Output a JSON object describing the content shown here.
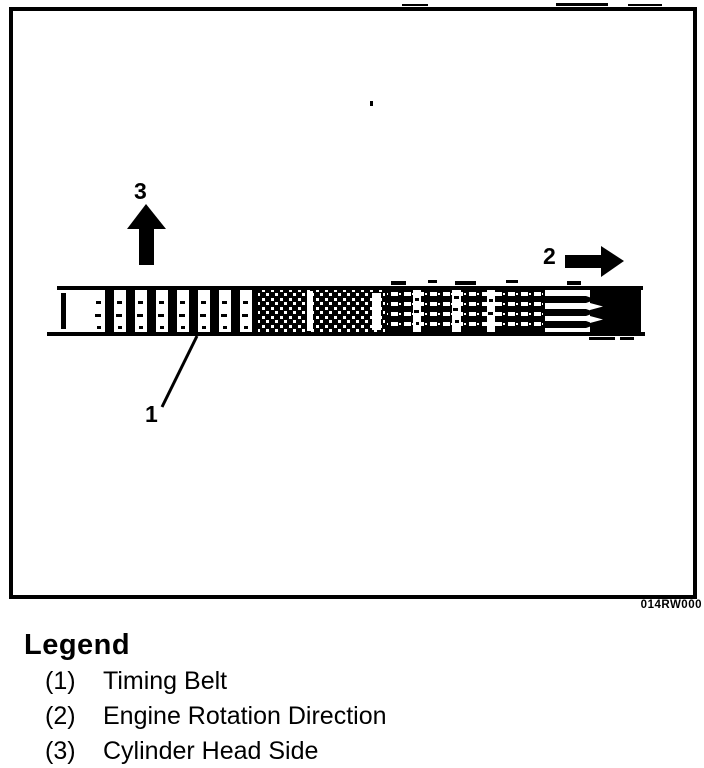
{
  "figure": {
    "code": "014RW000",
    "callouts": [
      {
        "number": "1"
      },
      {
        "number": "2"
      },
      {
        "number": "3"
      }
    ]
  },
  "legend": {
    "title": "Legend",
    "items": [
      {
        "number": "(1)",
        "label": "Timing Belt"
      },
      {
        "number": "(2)",
        "label": "Engine Rotation Direction"
      },
      {
        "number": "(3)",
        "label": "Cylinder Head Side"
      }
    ]
  },
  "colors": {
    "ink": "#000000",
    "paper": "#ffffff"
  }
}
